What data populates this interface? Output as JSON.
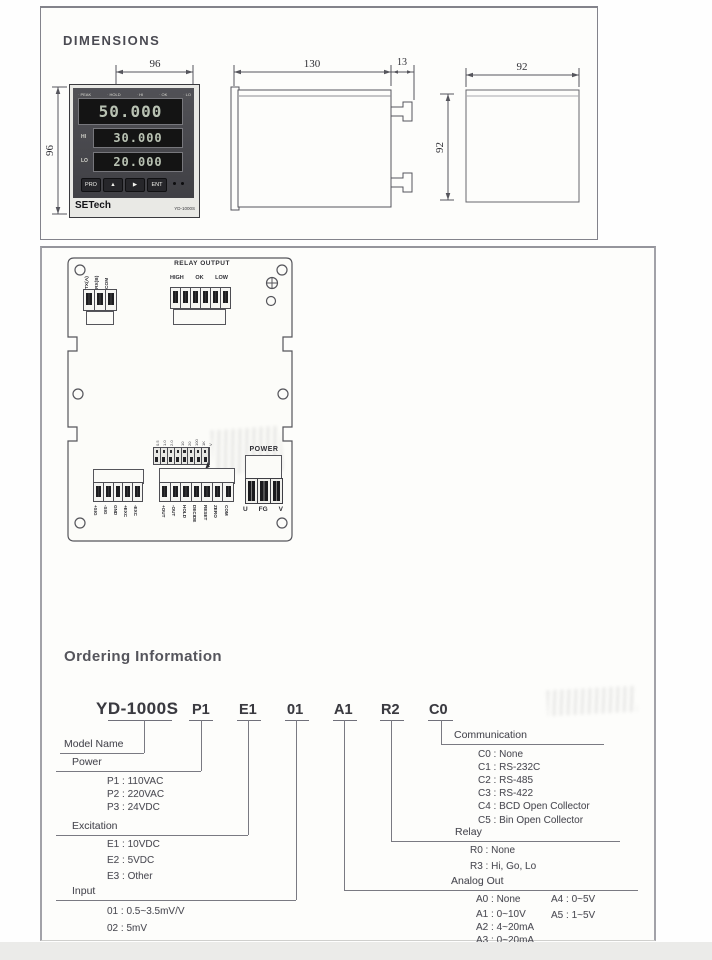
{
  "dimensions": {
    "title": "DIMENSIONS",
    "front": {
      "width_label": "96",
      "height_label": "96",
      "indicators": [
        "PEAK",
        "HOLD",
        "HI",
        "OK",
        "LO"
      ],
      "main_value": "50.000",
      "hi_label": "HI",
      "hi_value": "30.000",
      "lo_label": "LO",
      "lo_value": "20.000",
      "buttons": [
        "PRO",
        "▲",
        "▶",
        "ENT"
      ],
      "brand": "SETech",
      "model": "YD-1000S"
    },
    "side": {
      "depth_label": "130",
      "clip_label": "13",
      "height_label": "92"
    },
    "back": {
      "width_label": "92"
    }
  },
  "rear_panel": {
    "serial_terminals": [
      "TX(A)",
      "RX(B)",
      "COM"
    ],
    "relay_title": "RELAY OUTPUT",
    "relay_labels": [
      "HIGH",
      "OK",
      "LOW"
    ],
    "jumper_labels": [
      "0.5",
      "1.0",
      "2.0",
      "10",
      "20",
      "100",
      "1K",
      "V"
    ],
    "signal_terminals": [
      "+SIG",
      "-SIG",
      "GND",
      "+EXC",
      "-EXC"
    ],
    "io_terminals": [
      "+OUT",
      "-OUT",
      "HOLD",
      "DECIDE",
      "RESET",
      "ZERO",
      "COM"
    ],
    "power_title": "POWER",
    "power_terminals": [
      "U",
      "FG",
      "V"
    ]
  },
  "ordering": {
    "title": "Ordering Information",
    "codes": [
      "YD-1000S",
      "P1",
      "E1",
      "01",
      "A1",
      "R2",
      "C0"
    ],
    "model_name_label": "Model Name",
    "power": {
      "label": "Power",
      "items": [
        "P1 : 110VAC",
        "P2 : 220VAC",
        "P3 : 24VDC"
      ]
    },
    "excitation": {
      "label": "Excitation",
      "items": [
        "E1 : 10VDC",
        "E2 : 5VDC",
        "E3 : Other"
      ]
    },
    "input": {
      "label": "Input",
      "items": [
        "01 : 0.5~3.5mV/V",
        "02 : 5mV"
      ]
    },
    "communication": {
      "label": "Communication",
      "items": [
        "C0 : None",
        "C1 : RS-232C",
        "C2 : RS-485",
        "C3 : RS-422",
        "C4 : BCD Open Collector",
        "C5 : Bin Open Collector"
      ]
    },
    "relay": {
      "label": "Relay",
      "items": [
        "R0 : None",
        "R3 : Hi,  Go, Lo"
      ]
    },
    "analog": {
      "label": "Analog Out",
      "col1": [
        "A0 : None",
        "A1 : 0~10V",
        "A2 : 4~20mA",
        "A3 : 0~20mA"
      ],
      "col2": [
        "A4 : 0~5V",
        "A5 : 1~5V"
      ]
    }
  }
}
